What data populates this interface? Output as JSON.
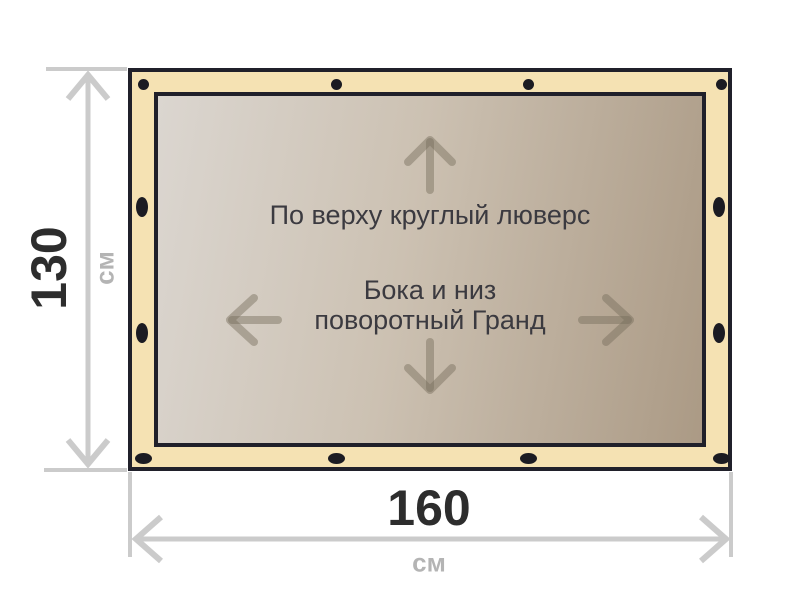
{
  "diagram": {
    "banner": {
      "top_note": "По верху круглый люверс",
      "middle_note_line1": "Бока и низ",
      "middle_note_line2": "поворотный Гранд"
    },
    "height_dimension": {
      "value": "130",
      "unit": "см"
    },
    "width_dimension": {
      "value": "160",
      "unit": "см"
    },
    "grommets": {
      "top_count": 4,
      "bottom_count": 4,
      "left_count": 2,
      "right_count": 2
    },
    "icons": [
      "arrow-up-icon",
      "arrow-down-icon",
      "arrow-left-icon",
      "arrow-right-icon",
      "height-dimension-arrow",
      "width-dimension-arrow",
      "grommet"
    ]
  },
  "colors": {
    "banner_fill": "#f5e2b3",
    "frame_stroke": "#20202a",
    "grommet": "#1b1b22",
    "grad_1": "#dbd6d0",
    "grad_2": "#ccc1b2",
    "grad_3": "#ab9a85",
    "dim_gray": "#cbcbcb",
    "number_dark": "#2d2d2d",
    "unit_gray": "#b4b4b4",
    "note_text": "#3b3a40",
    "inner_arrow": "rgba(117,108,92,0.45)"
  }
}
